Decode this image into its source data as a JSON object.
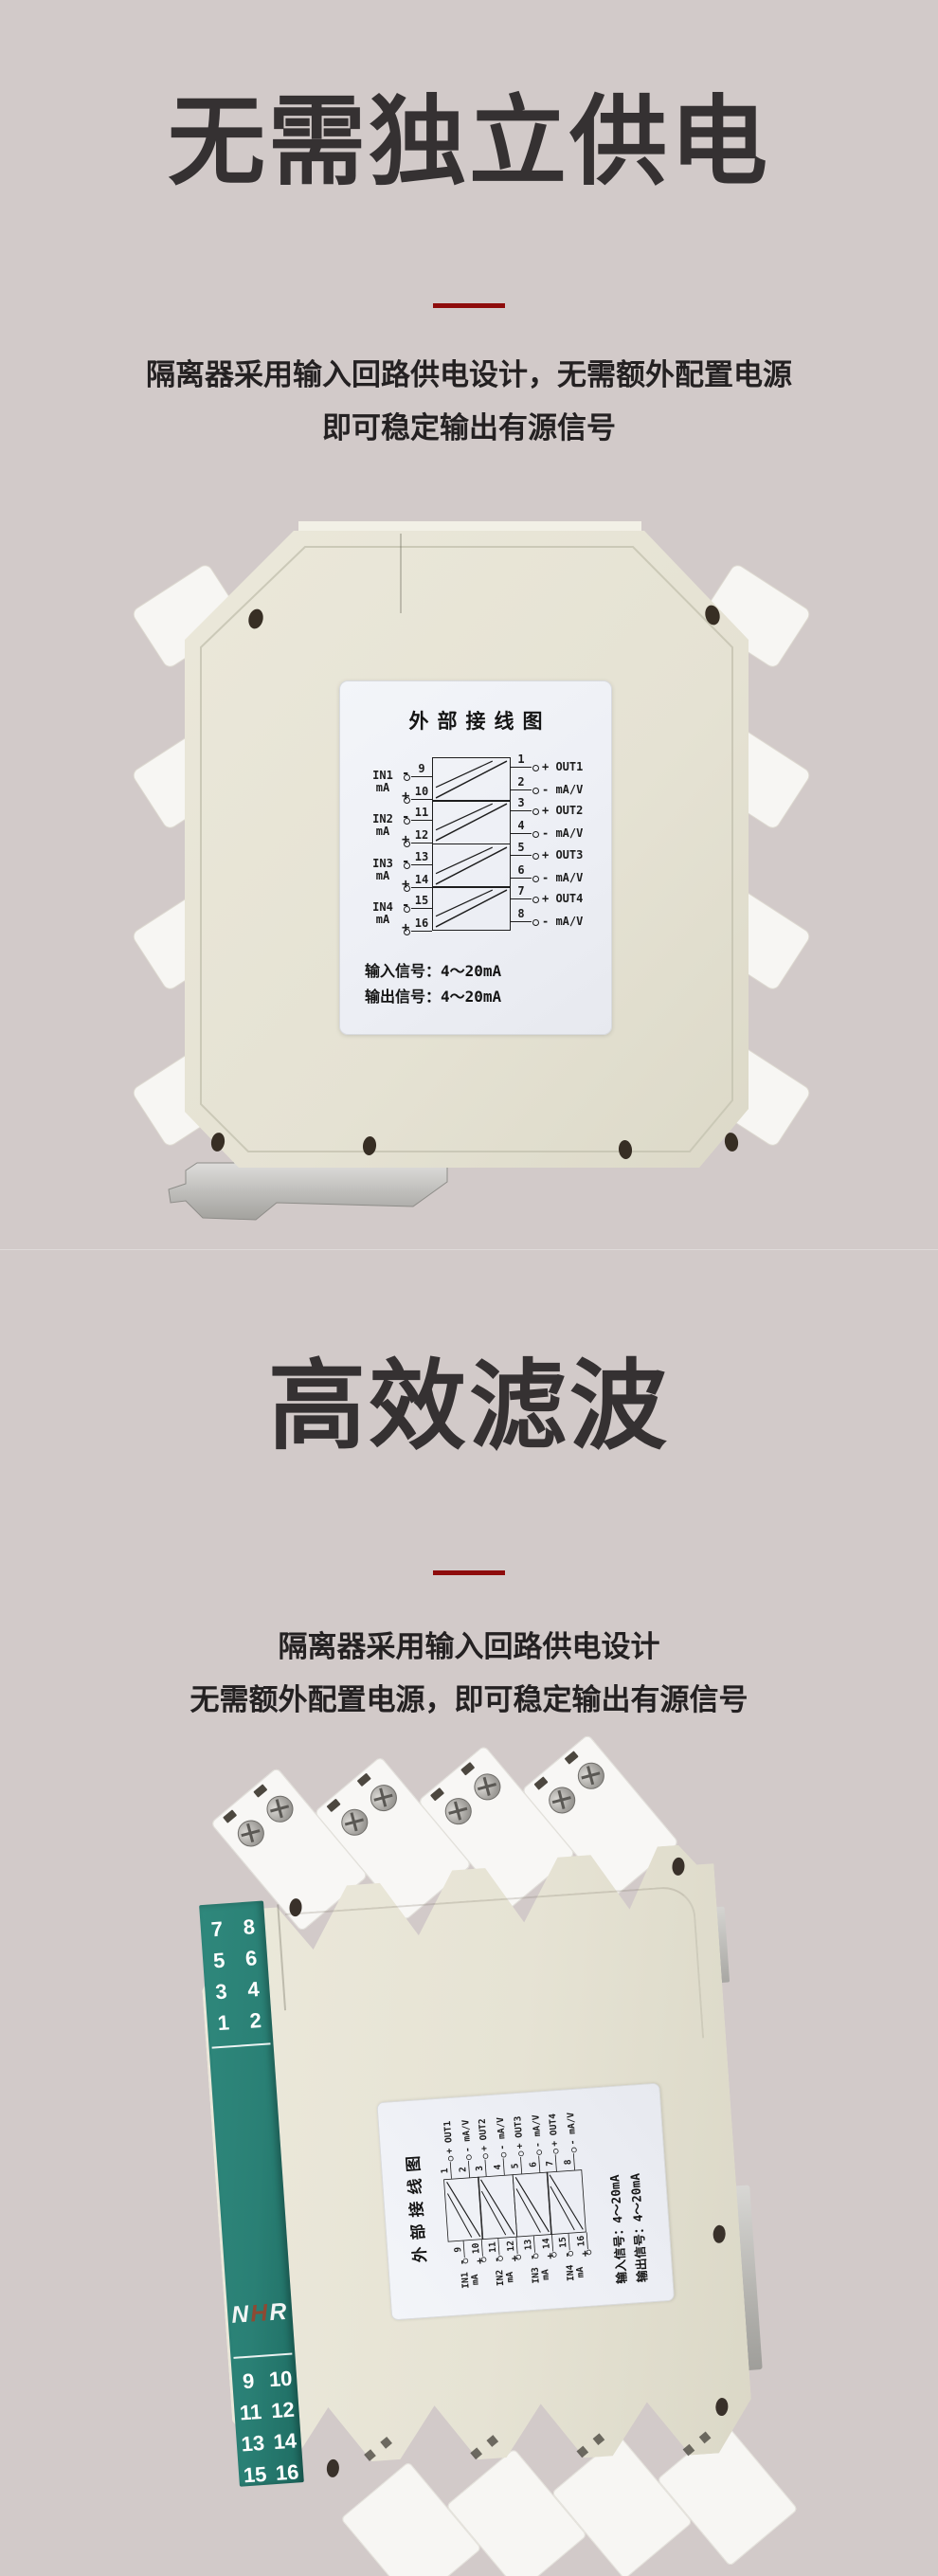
{
  "page": {
    "background": "#d2cac9",
    "accent_red": "#8e0c0c"
  },
  "section1": {
    "title": "无需独立供电",
    "desc_line1": "隔离器采用输入回路供电设计，无需额外配置电源",
    "desc_line2": "即可稳定输出有源信号"
  },
  "section2": {
    "title": "高效滤波",
    "desc_line1": "隔离器采用输入回路供电设计",
    "desc_line2": "无需额外配置电源，即可稳定输出有源信号"
  },
  "wiring_label": {
    "title": "外部接线图",
    "minus": "-",
    "plus": "+",
    "channels": [
      {
        "in_name": "IN1",
        "in_unit": "mA",
        "n_top": "9",
        "n_bot": "10",
        "out_n_top": "1",
        "out_n_bot": "2",
        "out_top": "+ OUT1",
        "out_bot": "- mA/V"
      },
      {
        "in_name": "IN2",
        "in_unit": "mA",
        "n_top": "11",
        "n_bot": "12",
        "out_n_top": "3",
        "out_n_bot": "4",
        "out_top": "+ OUT2",
        "out_bot": "- mA/V"
      },
      {
        "in_name": "IN3",
        "in_unit": "mA",
        "n_top": "13",
        "n_bot": "14",
        "out_n_top": "5",
        "out_n_bot": "6",
        "out_top": "+ OUT3",
        "out_bot": "- mA/V"
      },
      {
        "in_name": "IN4",
        "in_unit": "mA",
        "n_top": "15",
        "n_bot": "16",
        "out_n_top": "7",
        "out_n_bot": "8",
        "out_top": "+ OUT4",
        "out_bot": "- mA/V"
      }
    ],
    "signal_in": "输入信号：4～20mA",
    "signal_out": "输出信号：4～20mA"
  },
  "side_panel": {
    "green": "#2c8277",
    "brand": {
      "n": "N",
      "h": "H",
      "r": "R",
      "h_color": "#8d4a33"
    },
    "top_rows": [
      {
        "l": "7",
        "r": "8"
      },
      {
        "l": "5",
        "r": "6"
      },
      {
        "l": "3",
        "r": "4"
      },
      {
        "l": "1",
        "r": "2"
      }
    ],
    "bottom_rows": [
      {
        "l": "9",
        "r": "10"
      },
      {
        "l": "11",
        "r": "12"
      },
      {
        "l": "13",
        "r": "14"
      },
      {
        "l": "15",
        "r": "16"
      }
    ]
  }
}
